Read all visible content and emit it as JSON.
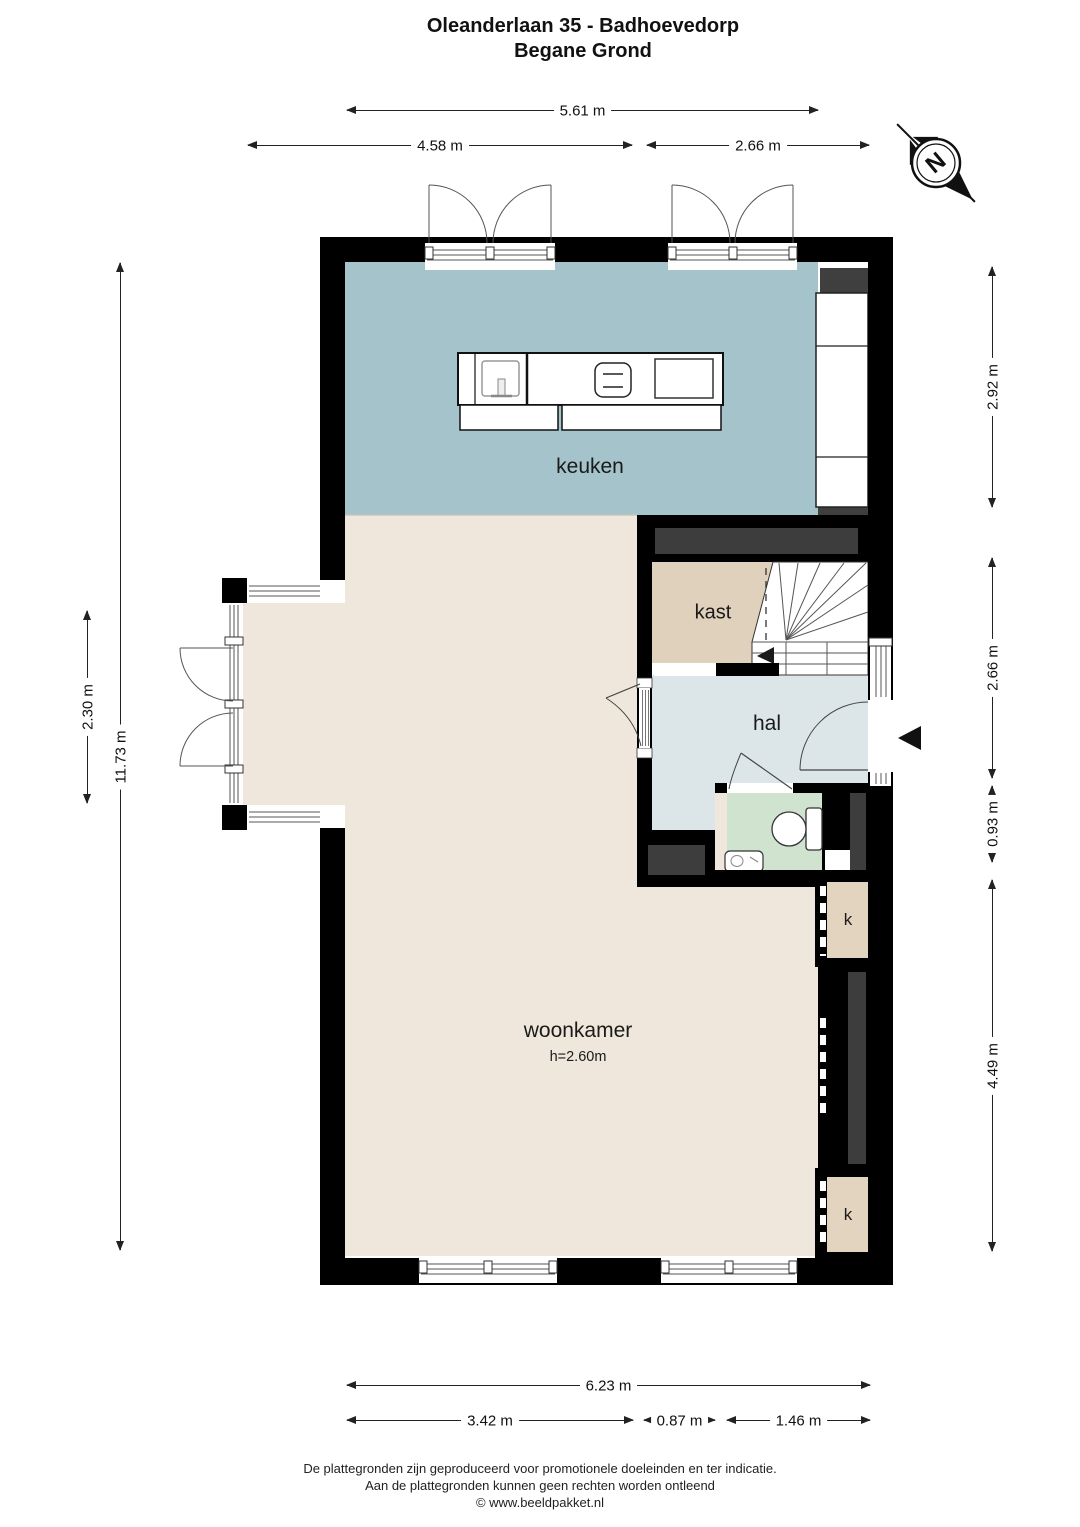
{
  "title": {
    "line1": "Oleanderlaan 35 - Badhoevedorp",
    "line2": "Begane Grond"
  },
  "rooms": {
    "kitchen": "keuken",
    "closet": "kast",
    "hall": "hal",
    "living_room": "woonkamer",
    "living_room_height": "h=2.60m",
    "cupboard_top": "k",
    "cupboard_bottom": "k"
  },
  "compass": {
    "north_label": "N"
  },
  "dimensions": {
    "top_total": "5.61 m",
    "top_left": "4.58 m",
    "top_right": "2.66 m",
    "left_bay": "2.30 m",
    "left_total": "11.73 m",
    "right_kitchen": "2.92 m",
    "right_hall": "2.66 m",
    "right_toilet": "0.93 m",
    "right_living": "4.49 m",
    "bottom_total": "6.23 m",
    "bottom_left": "3.42 m",
    "bottom_middle": "0.87 m",
    "bottom_right": "1.46 m"
  },
  "footer": {
    "line1": "De plattegronden zijn geproduceerd voor promotionele doeleinden en ter indicatie.",
    "line2": "Aan de plattegronden kunnen geen rechten worden ontleend",
    "line3": "© www.beeldpakket.nl"
  },
  "colors": {
    "wall": "#000000",
    "kitchen_floor": "#a4c3ca",
    "living_floor": "#efe7db",
    "closet_floor": "#dfd1bb",
    "hall_floor": "#dce6e8",
    "toilet_floor": "#cfe3cf",
    "cupboard_floor": "#e2d4be",
    "void_dark": "#3d3d3d"
  }
}
